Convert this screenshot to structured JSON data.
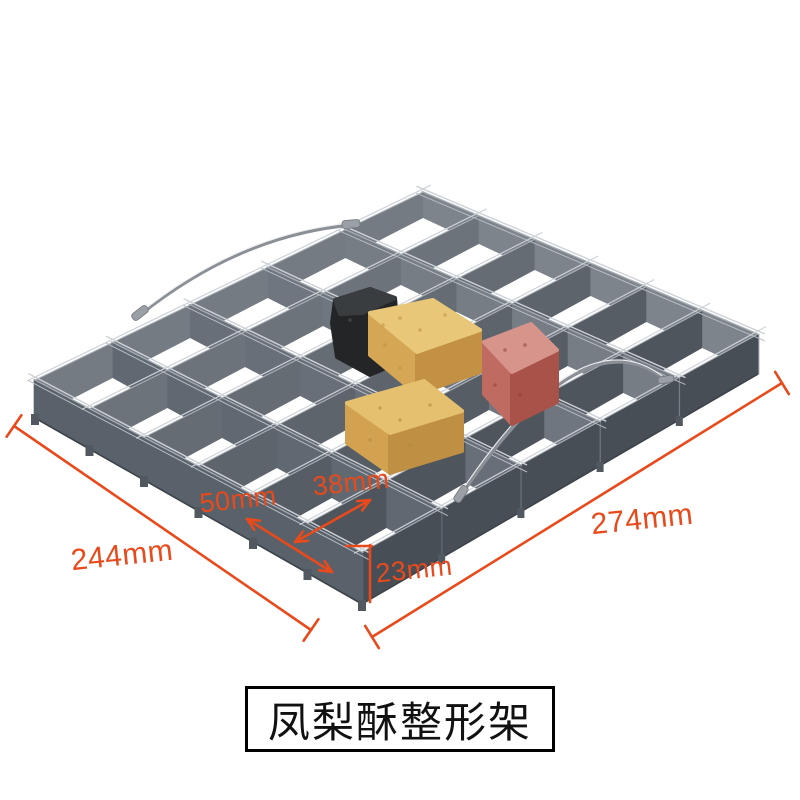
{
  "page": {
    "background": "#ffffff"
  },
  "annotations": {
    "color": "#e94a1b",
    "overall_left": "244mm",
    "overall_right": "274mm",
    "cell_width": "50mm",
    "cell_depth": "38mm",
    "frame_height": "23mm"
  },
  "caption": {
    "text": "凤梨酥整形架",
    "border_color": "#000000",
    "text_color": "#111111"
  },
  "rack": {
    "rows": 5,
    "columns": 6,
    "wall_color_left": "#59616a",
    "wall_color_right": "#474e56",
    "wall_haze": "#8d939b",
    "wall_top_highlight": "#a6adb4",
    "wall_dark_edge": "#3c434a",
    "wire_color": "#cdd2d7",
    "handle_color": "#8a9096",
    "handle_highlight": "#eceeef",
    "sleeve_color": "#9aa0a6"
  },
  "cakes": [
    {
      "name": "black-pineapple-cake",
      "top": "#3a3d40",
      "left": "#232527",
      "right": "#232527",
      "speckle": "#55585b"
    },
    {
      "name": "yellow-pineapple-cake-back",
      "top": "#e8c878",
      "left": "#d5a754",
      "right": "#c29143",
      "speckle": "#b98f3e"
    },
    {
      "name": "pink-pineapple-cake",
      "top": "#d6948b",
      "left": "#c06b61",
      "right": "#a95249",
      "speckle": "#8f4038"
    },
    {
      "name": "yellow-pineapple-cake-front",
      "top": "#e5c06e",
      "left": "#d2a250",
      "right": "#bf9044",
      "speckle": "#b08738"
    }
  ]
}
